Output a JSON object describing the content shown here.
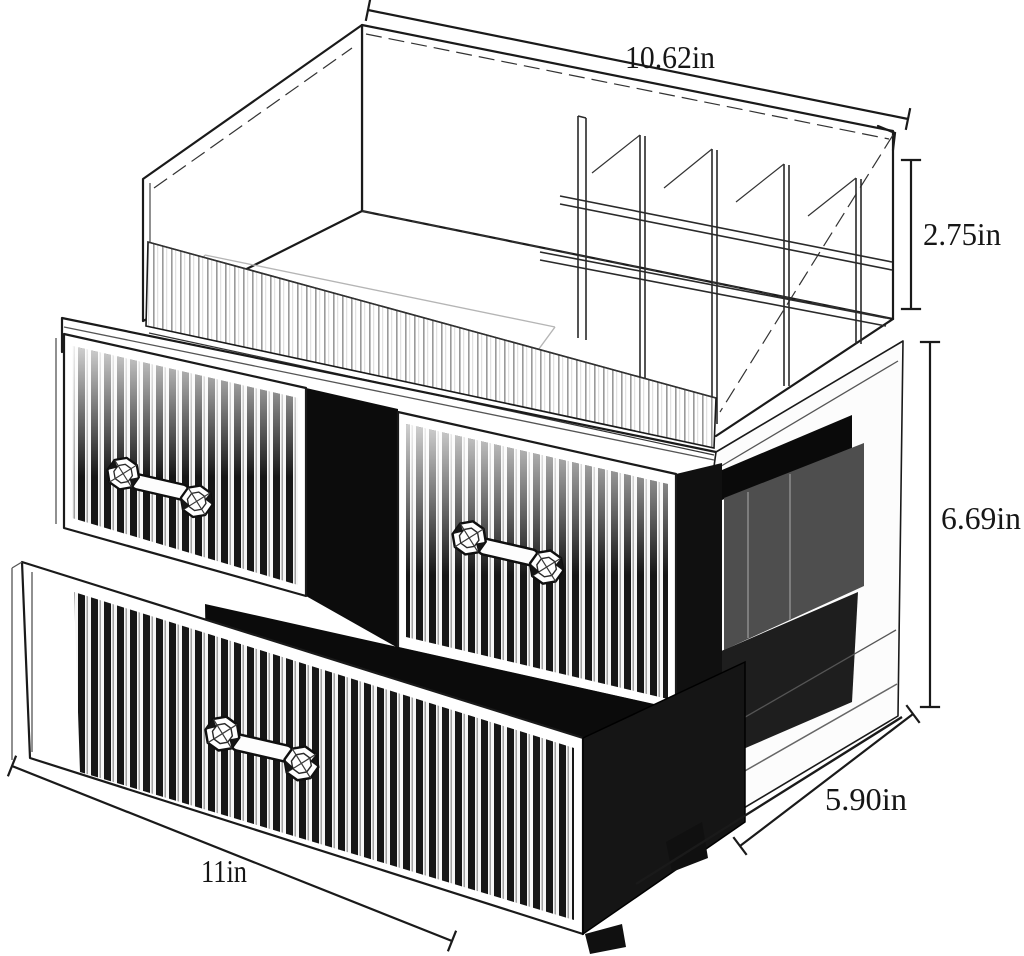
{
  "diagram": {
    "background": "#ffffff",
    "ink": "#1a1a1a",
    "interior_dark": "#0c0c0c",
    "interior_gray": "#4e4e4e",
    "labels": {
      "top_width": "10.62in",
      "top_section_height": "2.75in",
      "body_height": "6.69in",
      "depth": "5.90in",
      "bottom_width": "11in"
    }
  }
}
